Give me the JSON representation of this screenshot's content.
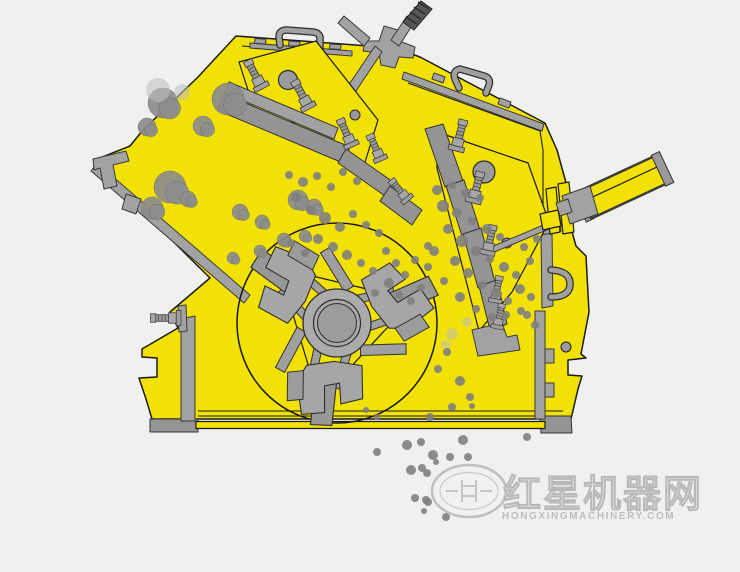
{
  "image": {
    "alt": "Cutaway working-principle diagram of an impact crusher: rocks slide down the feed chute at the upper left, a rotor with three blow-bar hammers spins inside a yellow housing beneath two hinged impact-plate curtains fitted with spring bolts, an adjusting cylinder protrudes from the right wall, and crushed particles fall from the bottom discharge.",
    "background_color": "#f0f0ee"
  },
  "colors": {
    "housing_yellow": "#f2e104",
    "outline_black": "#1b1b1b",
    "steel_gray": "#a2a2a2",
    "steel_gray_dark": "#8c8c8c",
    "rock_gray": "#8d8d8d",
    "watermark_gray": "#9e9e9e"
  },
  "watermark": {
    "cn": "红星机器网",
    "en": "HONGXINGMACHINERY.COM"
  },
  "diagram": {
    "rocks_large": [
      [
        163,
        103,
        15
      ],
      [
        147,
        127,
        9
      ],
      [
        228,
        99,
        16
      ],
      [
        203,
        126,
        10
      ],
      [
        170,
        187,
        16
      ],
      [
        152,
        208,
        11
      ],
      [
        188,
        199,
        8
      ],
      [
        240,
        212,
        8
      ],
      [
        298,
        200,
        10
      ],
      [
        314,
        207,
        8
      ],
      [
        262,
        222,
        7
      ],
      [
        284,
        240,
        7
      ],
      [
        305,
        236,
        6
      ],
      [
        260,
        251,
        6
      ],
      [
        233,
        258,
        6
      ]
    ],
    "rocks_faint": [
      [
        158,
        90,
        12
      ],
      [
        182,
        92,
        8
      ],
      [
        452,
        334,
        6
      ],
      [
        467,
        322,
        5
      ],
      [
        446,
        345,
        5
      ]
    ],
    "particles_mid": [
      [
        289,
        175,
        4
      ],
      [
        303,
        182,
        5
      ],
      [
        317,
        176,
        4
      ],
      [
        331,
        187,
        4
      ],
      [
        296,
        197,
        5
      ],
      [
        343,
        172,
        4
      ],
      [
        357,
        181,
        4
      ],
      [
        311,
        210,
        5
      ],
      [
        325,
        218,
        6
      ],
      [
        340,
        227,
        5
      ],
      [
        353,
        214,
        4
      ],
      [
        366,
        225,
        4
      ],
      [
        379,
        233,
        4
      ],
      [
        318,
        239,
        5
      ],
      [
        333,
        247,
        5
      ],
      [
        347,
        255,
        5
      ],
      [
        361,
        263,
        4
      ],
      [
        373,
        271,
        4
      ],
      [
        305,
        253,
        4
      ],
      [
        291,
        243,
        4
      ],
      [
        386,
        251,
        4
      ],
      [
        396,
        263,
        4
      ],
      [
        405,
        275,
        4
      ],
      [
        389,
        283,
        5
      ],
      [
        375,
        293,
        4
      ],
      [
        399,
        295,
        4
      ],
      [
        411,
        301,
        4
      ],
      [
        421,
        288,
        4
      ],
      [
        415,
        260,
        4
      ],
      [
        428,
        246,
        4
      ]
    ],
    "particles_right": [
      [
        437,
        190,
        5
      ],
      [
        452,
        185,
        4
      ],
      [
        466,
        193,
        5
      ],
      [
        480,
        198,
        4
      ],
      [
        443,
        206,
        6
      ],
      [
        457,
        213,
        5
      ],
      [
        472,
        221,
        4
      ],
      [
        487,
        229,
        5
      ],
      [
        500,
        237,
        4
      ],
      [
        448,
        229,
        5
      ],
      [
        462,
        241,
        6
      ],
      [
        476,
        251,
        5
      ],
      [
        490,
        259,
        4
      ],
      [
        504,
        267,
        5
      ],
      [
        516,
        275,
        4
      ],
      [
        455,
        261,
        5
      ],
      [
        468,
        273,
        5
      ],
      [
        482,
        285,
        4
      ],
      [
        496,
        293,
        5
      ],
      [
        508,
        301,
        4
      ],
      [
        520,
        289,
        5
      ],
      [
        531,
        297,
        4
      ],
      [
        444,
        281,
        4
      ],
      [
        460,
        297,
        5
      ],
      [
        476,
        309,
        4
      ],
      [
        492,
        317,
        4
      ],
      [
        506,
        315,
        4
      ],
      [
        521,
        311,
        4
      ],
      [
        434,
        251,
        5
      ],
      [
        428,
        267,
        4
      ],
      [
        530,
        261,
        4
      ],
      [
        524,
        247,
        4
      ],
      [
        537,
        239,
        4
      ],
      [
        527,
        315,
        4
      ],
      [
        535,
        325,
        4
      ]
    ],
    "particles_lower": [
      [
        447,
        352,
        4
      ],
      [
        438,
        369,
        4
      ],
      [
        460,
        381,
        5
      ],
      [
        470,
        397,
        4
      ],
      [
        452,
        407,
        4
      ]
    ],
    "particles_bottom": [
      [
        377,
        452,
        4
      ],
      [
        407,
        445,
        5
      ],
      [
        421,
        442,
        4
      ],
      [
        433,
        455,
        5
      ],
      [
        450,
        457,
        4
      ],
      [
        463,
        440,
        5
      ],
      [
        468,
        457,
        4
      ],
      [
        411,
        470,
        5
      ],
      [
        422,
        468,
        4
      ],
      [
        415,
        498,
        4
      ],
      [
        426,
        500,
        4
      ],
      [
        430,
        417,
        4
      ],
      [
        472,
        406,
        3
      ],
      [
        366,
        410,
        3
      ],
      [
        377,
        417,
        3
      ],
      [
        527,
        437,
        4
      ],
      [
        427,
        473,
        4
      ],
      [
        428,
        502,
        4
      ],
      [
        446,
        517,
        4
      ],
      [
        424,
        511,
        3
      ],
      [
        436,
        462,
        3
      ]
    ]
  }
}
